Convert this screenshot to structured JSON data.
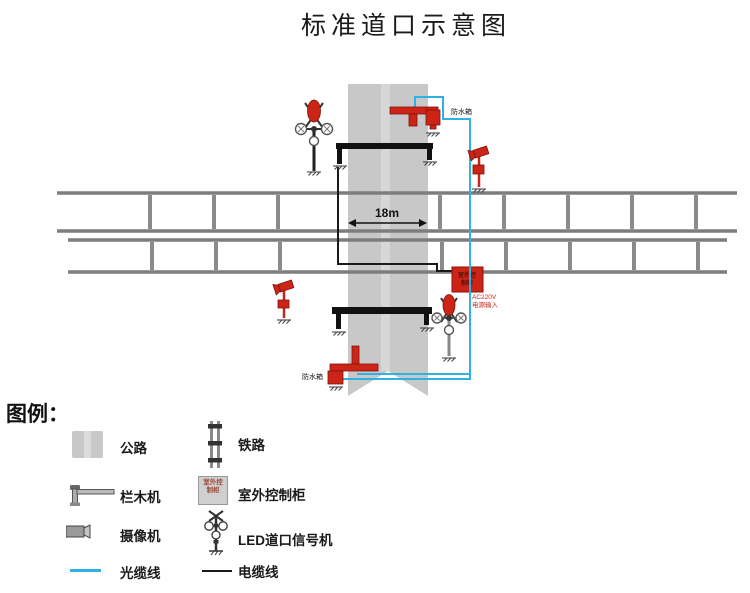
{
  "title": "标准道口示意图",
  "diagram": {
    "distance": "18m",
    "waterproof_top": "防水箱",
    "waterproof_bottom": "防水箱",
    "power_l1": "AC220V",
    "power_l2": "电源输入",
    "cabinet_l1": "室外控",
    "cabinet_l2": "制柜"
  },
  "legend": {
    "title": "图例：",
    "cabinet_icon": {
      "line1": "室外控",
      "line2": "制柜"
    },
    "left": [
      {
        "icon": "road-icon",
        "label": "公路"
      },
      {
        "icon": "barrier-machine-icon",
        "label": "栏木机"
      },
      {
        "icon": "camera-icon",
        "label": "摄像机"
      },
      {
        "icon": "optical-cable-icon",
        "label": "光缆线"
      }
    ],
    "right": [
      {
        "icon": "railway-icon",
        "label": "铁路"
      },
      {
        "icon": "outdoor-cabinet-icon",
        "label": "室外控制柜"
      },
      {
        "icon": "led-signal-icon",
        "label": "LED道口信号机"
      },
      {
        "icon": "electric-cable-icon",
        "label": "电缆线"
      }
    ]
  },
  "colors": {
    "road": "#c8c8c8",
    "road_stripe": "#d7d7d7",
    "rail": "#7d7d7d",
    "tie": "#8a8a8a",
    "device_red": "#cd2418",
    "optical_blue": "#2fb1e5",
    "cable_black": "#1a1a1a"
  }
}
